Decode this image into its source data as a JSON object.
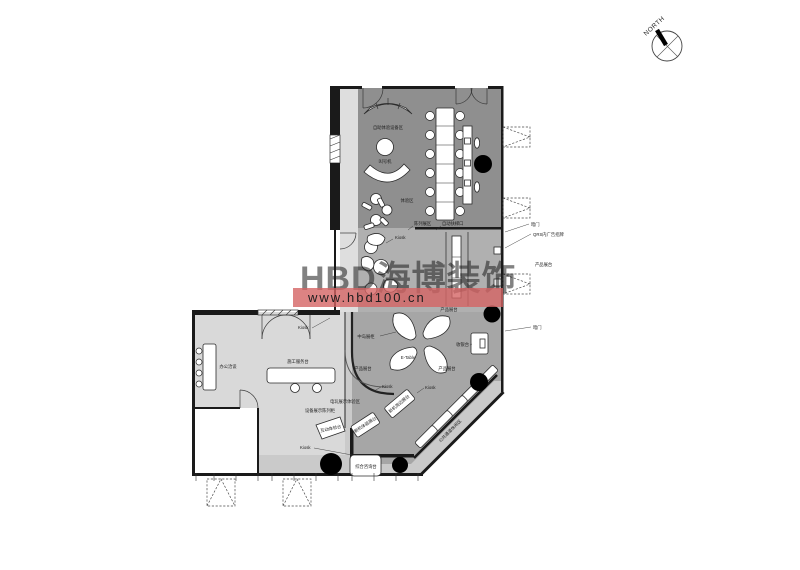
{
  "watermark": {
    "brand": "HBD海博装饰",
    "url": "www.hbd100.cn"
  },
  "compass": {
    "label": "NORTH"
  },
  "colors": {
    "floor_dark": "#8f8f8f",
    "floor_mid": "#b0b0b0",
    "floor_retail": "#a6a6a6",
    "floor_office": "#d9d9d9",
    "floor_corridor": "#cacaca",
    "floor_light": "#dedede",
    "wall": "#1a1a1a",
    "column": "#000000",
    "watermark_pink": "#de7b7b",
    "band_pink": "#d56464",
    "url_text": "#ffffff"
  },
  "labels": {
    "self_service": "自助体验设备区",
    "queue_machine": "叫号机",
    "experience_zone": "体验区",
    "display_zone": "陈列展区",
    "escalator_entry": "自动扶梯口",
    "hidden_door": "暗门",
    "ad_sign": "QRS内广告招牌",
    "product_display": "产品展台",
    "kiosk": "Kiosk",
    "island_display": "中岛展柜",
    "e_table": "E-Table",
    "cashier": "收银台",
    "office_meeting": "办公洽谈",
    "service_desk": "施工服务台",
    "game_display": "电玩展示体验区",
    "equipment_rack": "设备展示陈列柜",
    "touch_table": "互动体验台",
    "new_device_table": "新机体验展台",
    "new_device_side": "新机周边展台",
    "info_desk": "综合咨询台",
    "public_corridor": "公共通道休闲区"
  }
}
